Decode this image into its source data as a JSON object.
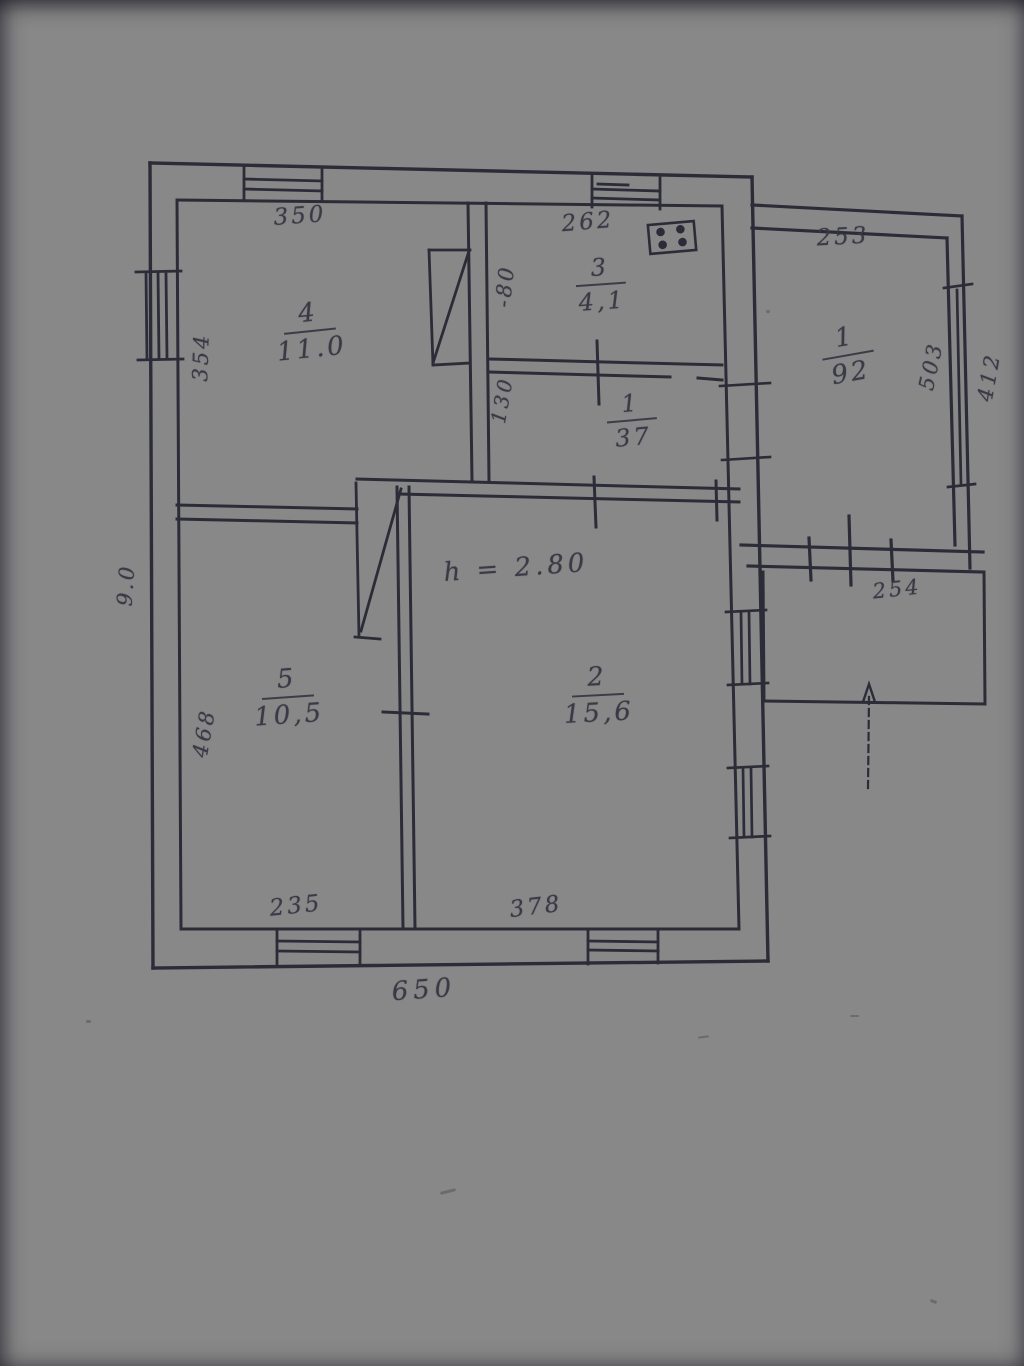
{
  "plan": {
    "ceiling_note": "h = 2.80",
    "rooms": [
      {
        "number": "4",
        "area": "11.0"
      },
      {
        "number": "3",
        "area": "4,1"
      },
      {
        "number": "1",
        "area": "37"
      },
      {
        "number": "1",
        "area": "92"
      },
      {
        "number": "5",
        "area": "10,5"
      },
      {
        "number": "2",
        "area": "15,6"
      }
    ],
    "dimensions": {
      "room4_top": "350",
      "room3_top": "262",
      "annex_top": "253",
      "left_upper": "354",
      "left_overall": "9.0",
      "left_lower": "468",
      "bottom_left": "235",
      "bottom_right": "378",
      "bottom_overall": "650",
      "annex_right_inner": "503",
      "annex_right_outer": "412",
      "porch_width": "254",
      "door_width": "-80",
      "hall_width": "130"
    },
    "icons": {
      "stove": "gas-stove-icon",
      "entry_arrow": "entrance-arrow-icon",
      "window": "window-symbol"
    }
  }
}
